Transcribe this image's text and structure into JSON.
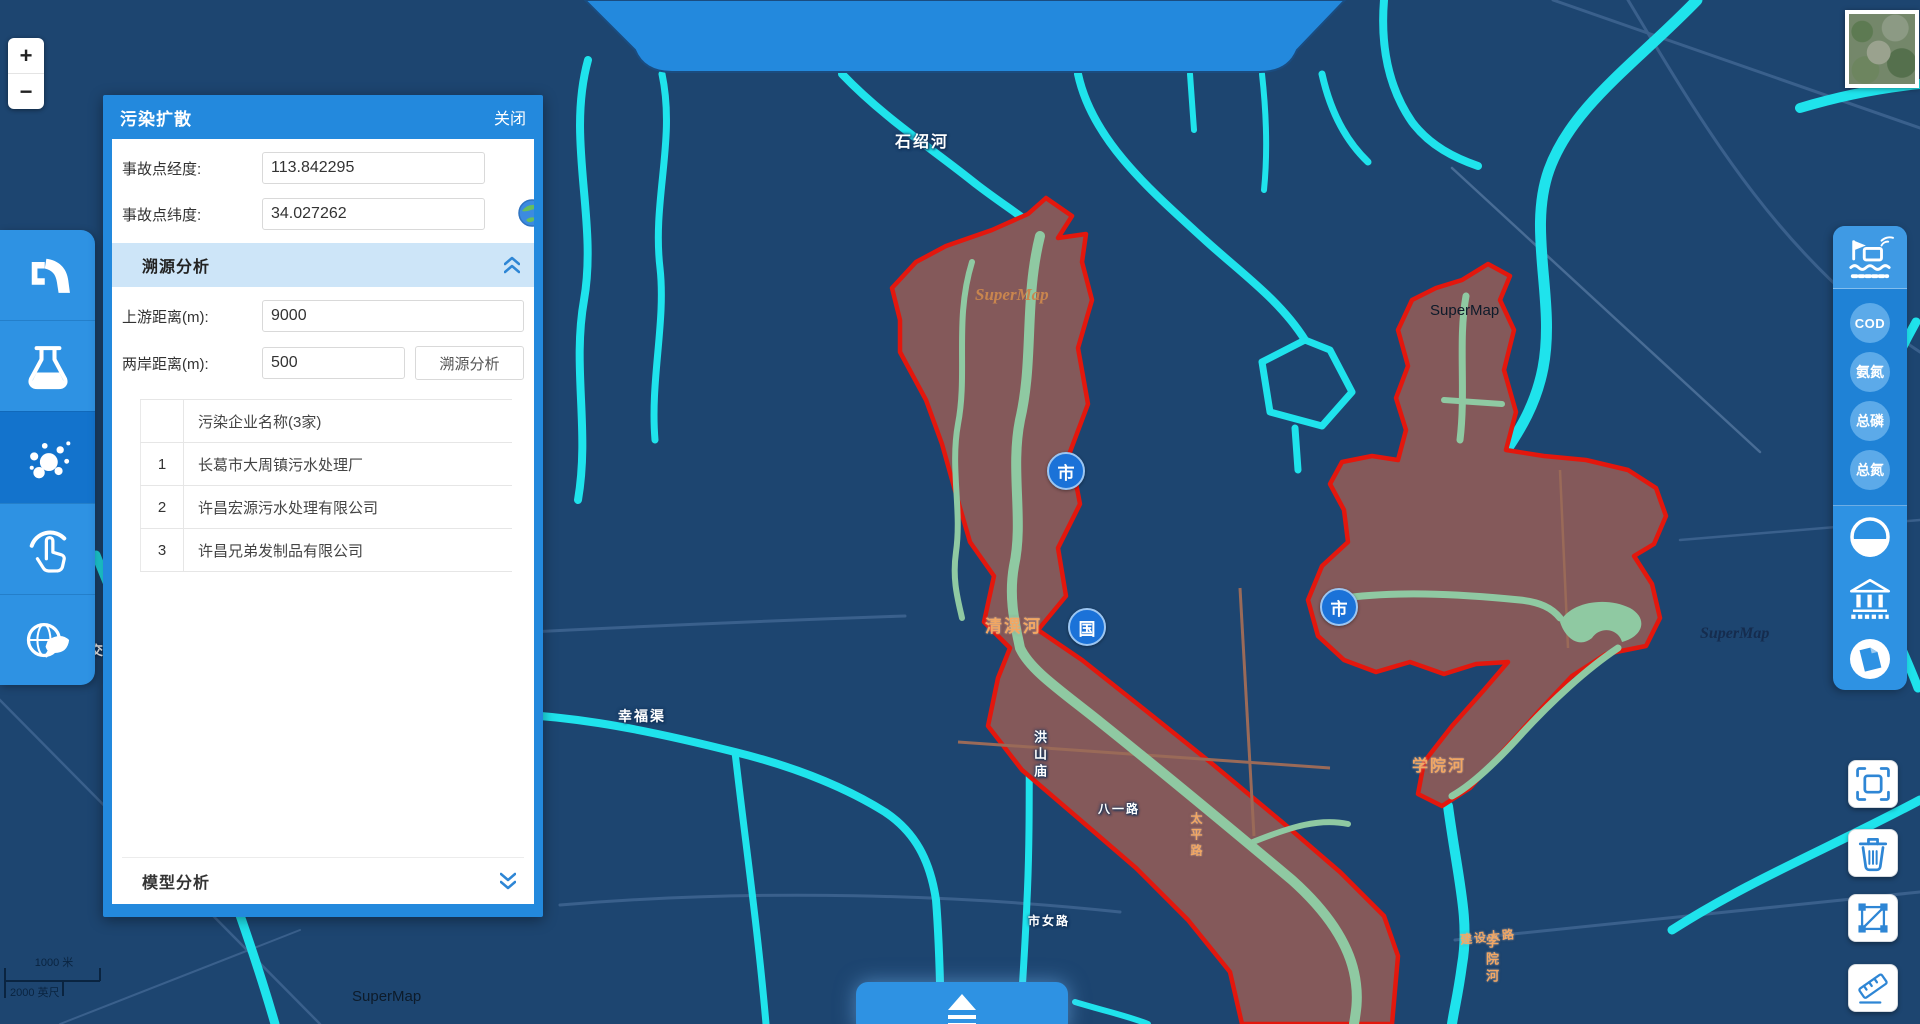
{
  "pollution_panel": {
    "title": "污染扩散",
    "close_label": "关闭",
    "longitude": {
      "label": "事故点经度:",
      "value": "113.842295"
    },
    "latitude": {
      "label": "事故点纬度:",
      "value": "34.027262"
    },
    "trace_section": {
      "title": "溯源分析",
      "upstream": {
        "label": "上游距离(m):",
        "value": "9000"
      },
      "bank": {
        "label": "两岸距离(m):",
        "value": "500"
      },
      "analyze_button": "溯源分析",
      "table": {
        "header": "污染企业名称(3家)",
        "rows": [
          {
            "index": "1",
            "name": "长葛市大周镇污水处理厂"
          },
          {
            "index": "2",
            "name": "许昌宏源污水处理有限公司"
          },
          {
            "index": "3",
            "name": "许昌兄弟发制品有限公司"
          }
        ]
      }
    },
    "model_section": {
      "title": "模型分析"
    }
  },
  "zoom_control": {
    "in": "+",
    "out": "−"
  },
  "left_toolbar": {
    "icons": [
      "pipe-icon",
      "flask-icon",
      "bubbles-icon",
      "hand-click-icon",
      "eco-globe-icon"
    ]
  },
  "right_toolbar": {
    "station_icon": "monitoring-station-icon",
    "badges": [
      "COD",
      "氨氮",
      "总磷",
      "总氮"
    ],
    "icons": [
      "half-circle-icon",
      "bank-icon",
      "document-circle-icon"
    ]
  },
  "map_tools": {
    "icons": [
      "expand-icon",
      "trash-icon",
      "polygon-select-icon",
      "measure-icon"
    ]
  },
  "map": {
    "labels": {
      "shishao_river": "石绍河",
      "qingyi_river": "清潩河",
      "xueyuan_river": "学院河",
      "xueyuan_river_vertical": "学院河",
      "xingfu_canal": "幸福渠",
      "hongshanmiao": "洪山庙",
      "bayi_road": "八一路",
      "taiping_road": "太平路",
      "shinv_road": "市女路",
      "jianshe_road": "建设大路",
      "jiao_char": "交"
    },
    "badges": {
      "city1": "市",
      "nation": "国",
      "city2": "市"
    },
    "watermarks": [
      "SuperMap",
      "SuperMap",
      "SuperMap",
      "SuperMap"
    ],
    "scale": {
      "metric": "1000 米",
      "imperial": "2000 英尺"
    }
  }
}
